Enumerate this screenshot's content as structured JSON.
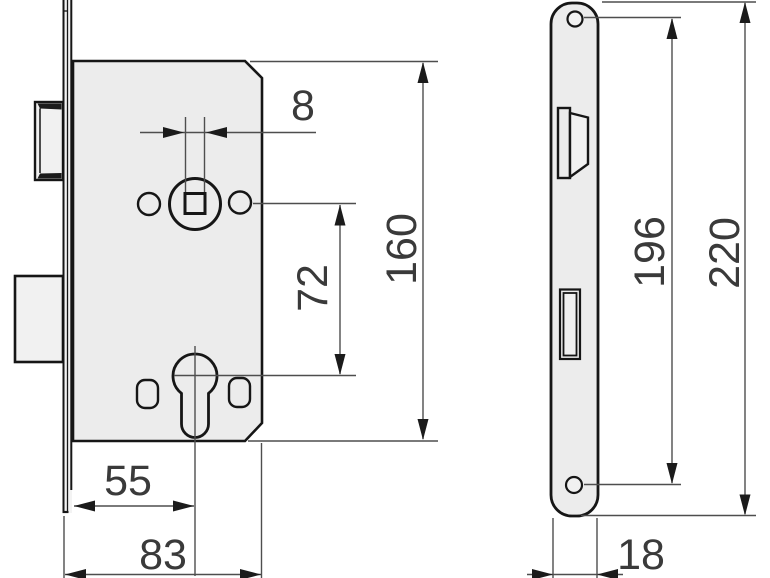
{
  "drawing": {
    "type": "technical-dimension-drawing",
    "views": {
      "side_view": "lock-case-side-view",
      "front_view": "faceplate-front-view"
    }
  },
  "dimensions": {
    "spindle_square": {
      "label": "8"
    },
    "case_height": {
      "label": "160"
    },
    "spindle_to_cylinder": {
      "label": "72"
    },
    "backset": {
      "label": "55"
    },
    "case_depth": {
      "label": "83"
    },
    "screw_hole_spacing": {
      "label": "196"
    },
    "faceplate_height": {
      "label": "220"
    },
    "faceplate_width": {
      "label": "18"
    }
  },
  "colors": {
    "background": "#ffffff",
    "outline": "#161616",
    "part_fill": "#ececec",
    "part_fill_light": "#f1f1f1",
    "bevel": "#1b1b1b",
    "dim_line": "#4e4e4e",
    "arrow": "#1b1b1b",
    "label": "#3a3a3a"
  }
}
